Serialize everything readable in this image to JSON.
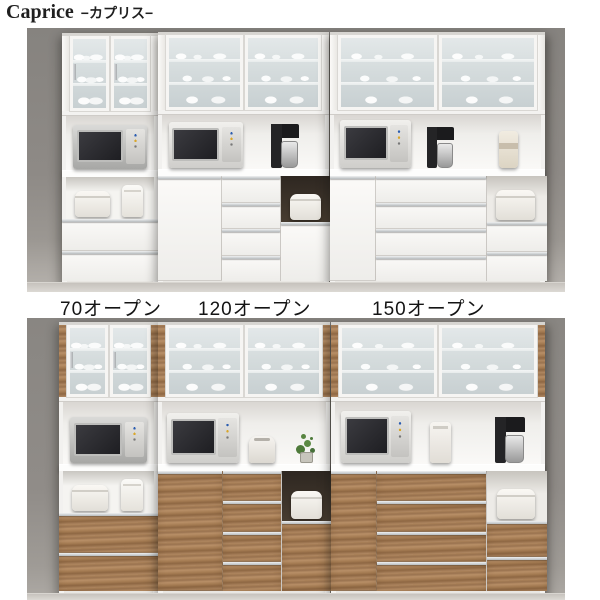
{
  "header": {
    "title_en": "Caprice",
    "title_jp": "−カプリス−"
  },
  "size_labels": [
    {
      "label": "70オープン"
    },
    {
      "label": "120オープン"
    },
    {
      "label": "150オープン"
    }
  ],
  "colors": {
    "page_background": "#ffffff",
    "photo_background": "#8e8a86",
    "floor": "#c6c2bd",
    "cabinet_white_finish": "#f4f3f1",
    "cabinet_walnut_finish": "#a67c52",
    "frosted_glass": "#d6dcde",
    "aluminum_handle": "#c9cccd",
    "niche_interior_dark": "#3e352b",
    "appliance_silver": "#c0c0be",
    "appliance_black": "#1c1c1e",
    "title_text": "#1f1f1f",
    "label_text": "#141414"
  }
}
